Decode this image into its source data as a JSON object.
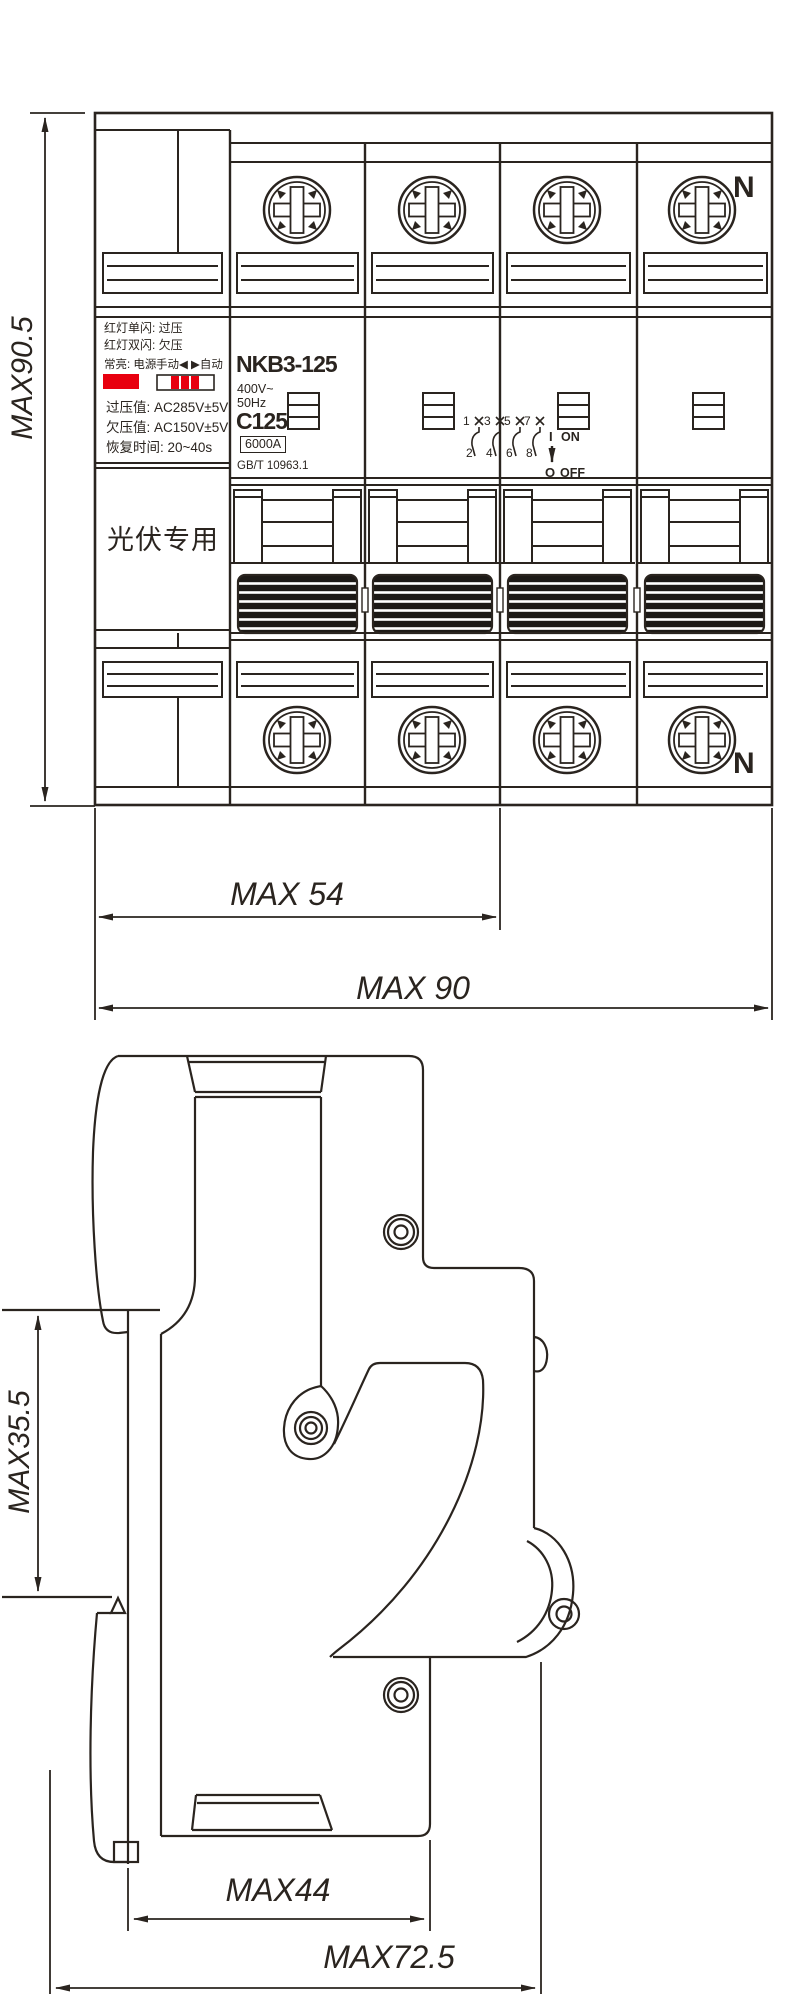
{
  "front_view": {
    "neutral_top": "N",
    "neutral_bottom": "N",
    "protection_module": {
      "indicator_line1": "红灯单闪: 过压",
      "indicator_line2": "红灯双闪: 欠压",
      "steady_label": "常亮: 电源",
      "manual_auto_label": "手动◀ ▶自动",
      "overvoltage_value": "过压值: AC285V±5V",
      "undervoltage_value": "欠压值: AC150V±5V",
      "recovery_time": "恢复时间: 20~40s",
      "application": "光伏专用",
      "indicator_color": "#e8000f"
    },
    "rating_label": {
      "model": "NKB3-125",
      "voltage": "400V~",
      "frequency": "50Hz",
      "curve_rating": "C125",
      "breaking_capacity": "6000A",
      "standard": "GB/T 10963.1"
    },
    "wiring_diagram": {
      "top_terminals": [
        "1",
        "3",
        "5",
        "7"
      ],
      "bottom_terminals": [
        "2",
        "4",
        "6",
        "8"
      ]
    },
    "switch_indicator": {
      "on_symbol": "I",
      "on_label": "ON",
      "off_symbol": "O",
      "off_label": "OFF"
    }
  },
  "dimensions": {
    "front_height": "MAX90.5",
    "front_width_partial": "MAX 54",
    "front_width_total": "MAX 90",
    "rail_height": "MAX35.5",
    "depth_partial": "MAX44",
    "depth_total": "MAX72.5"
  }
}
